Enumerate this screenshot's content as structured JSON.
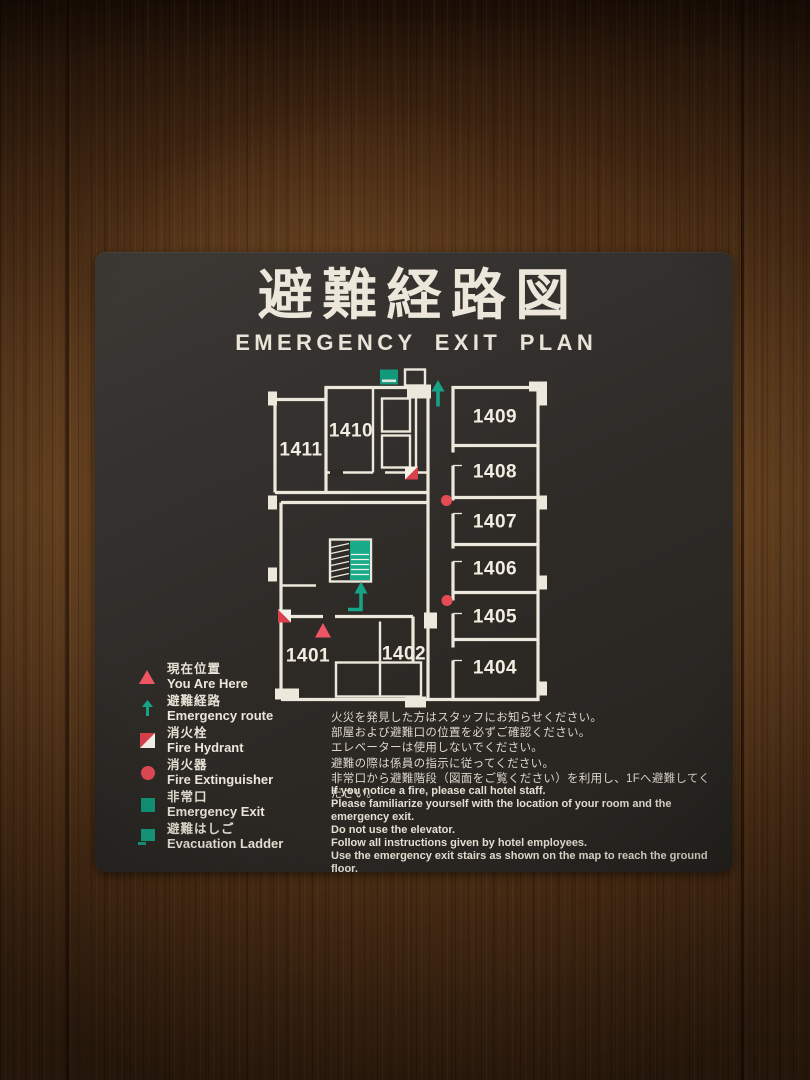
{
  "sign": {
    "title_jp": "避難経路図",
    "title_en": "EMERGENCY EXIT PLAN",
    "rooms": {
      "r1401": "1401",
      "r1402": "1402",
      "r1404": "1404",
      "r1405": "1405",
      "r1406": "1406",
      "r1407": "1407",
      "r1408": "1408",
      "r1409": "1409",
      "r1410": "1410",
      "r1411": "1411"
    },
    "legend": [
      {
        "icon": "you-are-here-triangle",
        "jp": "現在位置",
        "en": "You Are Here"
      },
      {
        "icon": "emergency-route-arrow",
        "jp": "避難経路",
        "en": "Emergency route"
      },
      {
        "icon": "fire-hydrant-square",
        "jp": "消火栓",
        "en": "Fire Hydrant"
      },
      {
        "icon": "fire-extinguisher-circle",
        "jp": "消火器",
        "en": "Fire Extinguisher"
      },
      {
        "icon": "emergency-exit-square",
        "jp": "非常口",
        "en": "Emergency Exit"
      },
      {
        "icon": "evacuation-ladder-square",
        "jp": "避難はしご",
        "en": "Evacuation Ladder"
      }
    ],
    "instructions_jp": [
      "火災を発見した方はスタッフにお知らせください。",
      "部屋および避難口の位置を必ずご確認ください。",
      "エレベーターは使用しないでください。",
      "避難の際は係員の指示に従ってください。",
      "非常口から避難階段（図面をご覧ください）を利用し、1Fへ避難してください。"
    ],
    "instructions_en": [
      "If you notice a fire, please call hotel staff.",
      "Please familiarize yourself with the location of your room and the emergency exit.",
      "Do not use the elevator.",
      "Follow all instructions given by hotel employees.",
      "Use the emergency exit stairs as shown on the map to reach the ground floor."
    ],
    "colors": {
      "sign_bg": "#2e2b27",
      "wall_white": "#ece8db",
      "accent_teal": "#16a386",
      "accent_red": "#e64b55",
      "triangle_red": "#ee5565",
      "wood_brown": "#5c3a1c"
    }
  }
}
